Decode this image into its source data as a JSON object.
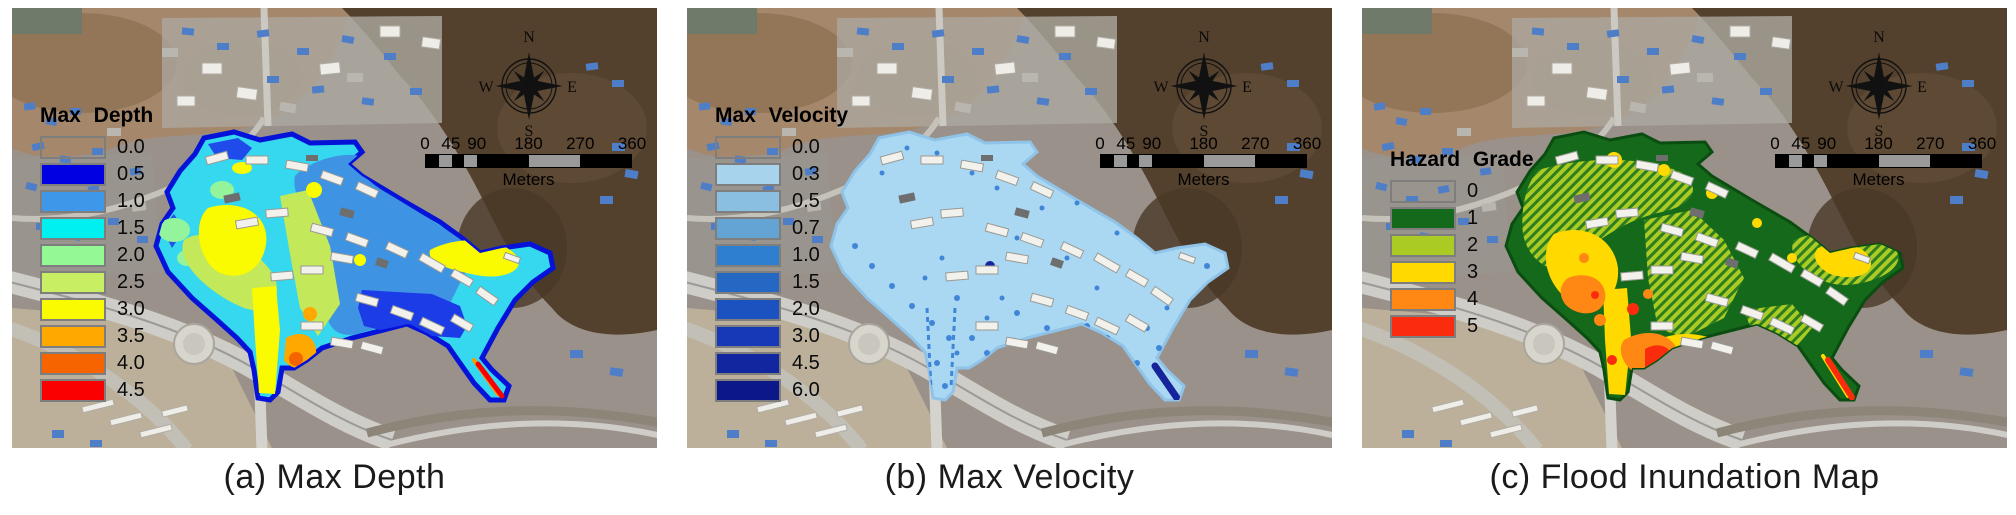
{
  "panels": [
    {
      "caption": "(a) Max Depth",
      "legend": {
        "title": "Max Depth",
        "entries": [
          {
            "label": "0.0",
            "color": "transparent"
          },
          {
            "label": "0.5",
            "color": "#0000E0"
          },
          {
            "label": "1.0",
            "color": "#3E97E8"
          },
          {
            "label": "1.5",
            "color": "#00F0F0"
          },
          {
            "label": "2.0",
            "color": "#94F894"
          },
          {
            "label": "2.5",
            "color": "#C8EE64"
          },
          {
            "label": "3.0",
            "color": "#FAFA00"
          },
          {
            "label": "3.5",
            "color": "#FFA800"
          },
          {
            "label": "4.0",
            "color": "#F66400"
          },
          {
            "label": "4.5",
            "color": "#FA0000"
          }
        ]
      }
    },
    {
      "caption": "(b) Max Velocity",
      "legend": {
        "title": "Max Velocity",
        "entries": [
          {
            "label": "0.0",
            "color": "transparent"
          },
          {
            "label": "0.3",
            "color": "#A8D3EC"
          },
          {
            "label": "0.5",
            "color": "#8BBFE2"
          },
          {
            "label": "0.7",
            "color": "#64A4D4"
          },
          {
            "label": "1.0",
            "color": "#2E7FD0"
          },
          {
            "label": "1.5",
            "color": "#2468C4"
          },
          {
            "label": "2.0",
            "color": "#1C51C0"
          },
          {
            "label": "3.0",
            "color": "#1739B8"
          },
          {
            "label": "4.5",
            "color": "#1226A0"
          },
          {
            "label": "6.0",
            "color": "#0D1888"
          }
        ]
      }
    },
    {
      "caption": "(c) Flood Inundation Map",
      "legend": {
        "title": "Hazard Grade",
        "entries": [
          {
            "label": "0",
            "color": "transparent"
          },
          {
            "label": "1",
            "color": "#15691B"
          },
          {
            "label": "2",
            "color": "#A9CB24"
          },
          {
            "label": "3",
            "color": "#FFD900"
          },
          {
            "label": "4",
            "color": "#FF8714"
          },
          {
            "label": "5",
            "color": "#FA2C0D"
          }
        ]
      }
    }
  ],
  "compass": {
    "north": "N",
    "south": "S",
    "east": "E",
    "west": "W"
  },
  "scalebar": {
    "tick_labels": [
      "0",
      "45",
      "90",
      "180",
      "270",
      "360"
    ],
    "unit_label": "Meters"
  }
}
